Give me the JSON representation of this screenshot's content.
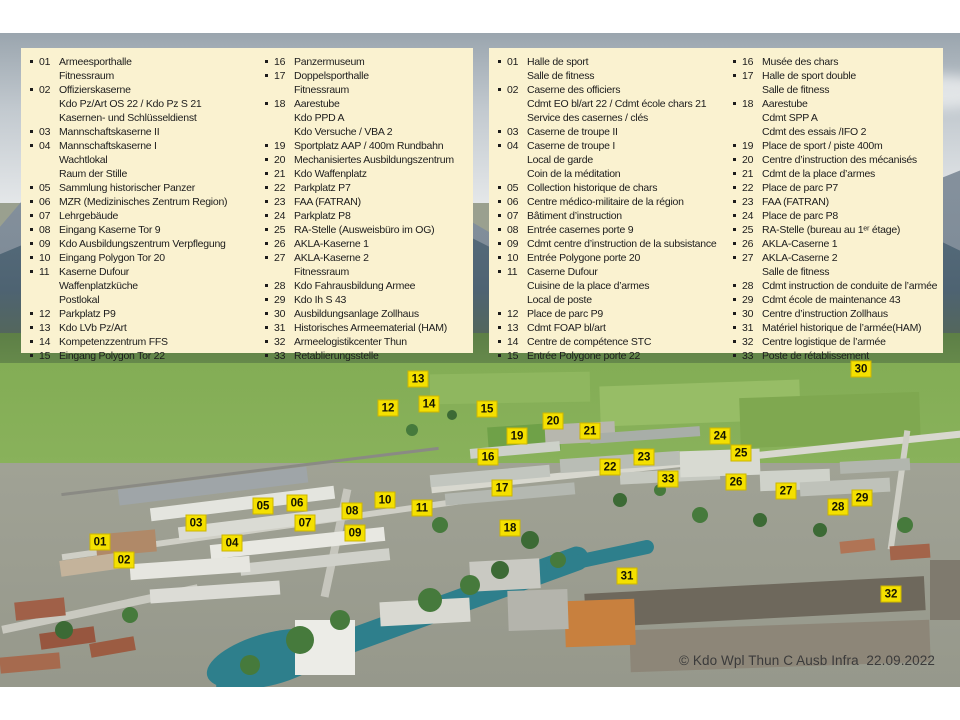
{
  "colors": {
    "legend_bg": "#FAF2D0",
    "marker_bg": "#F4E000",
    "marker_border": "#CDB600"
  },
  "copyright": "© Kdo Wpl Thun C Ausb Infra  22.09.2022",
  "legend_german": {
    "columns": [
      [
        {
          "num": "01",
          "lines": [
            "Armeesporthalle",
            "Fitnessraum"
          ]
        },
        {
          "num": "02",
          "lines": [
            "Offizierskaserne",
            "Kdo Pz/Art OS 22 / Kdo Pz S 21",
            "Kasernen- und Schlüsseldienst"
          ]
        },
        {
          "num": "03",
          "lines": [
            "Mannschaftskaserne II"
          ]
        },
        {
          "num": "04",
          "lines": [
            "Mannschaftskaserne I",
            "Wachtlokal",
            "Raum der Stille"
          ]
        },
        {
          "num": "05",
          "lines": [
            "Sammlung historischer Panzer"
          ]
        },
        {
          "num": "06",
          "lines": [
            "MZR (Medizinisches Zentrum Region)"
          ]
        },
        {
          "num": "07",
          "lines": [
            "Lehrgebäude"
          ]
        },
        {
          "num": "08",
          "lines": [
            "Eingang Kaserne Tor 9"
          ]
        },
        {
          "num": "09",
          "lines": [
            "Kdo Ausbildungszentrum Verpflegung"
          ]
        },
        {
          "num": "10",
          "lines": [
            "Eingang Polygon Tor 20"
          ]
        },
        {
          "num": "11",
          "lines": [
            "Kaserne Dufour",
            "Waffenplatzküche",
            "Postlokal"
          ]
        },
        {
          "num": "12",
          "lines": [
            "Parkplatz P9"
          ]
        },
        {
          "num": "13",
          "lines": [
            "Kdo LVb Pz/Art"
          ]
        },
        {
          "num": "14",
          "lines": [
            "Kompetenzzentrum FFS"
          ]
        },
        {
          "num": "15",
          "lines": [
            "Eingang Polygon Tor 22"
          ]
        }
      ],
      [
        {
          "num": "16",
          "lines": [
            "Panzermuseum"
          ]
        },
        {
          "num": "17",
          "lines": [
            "Doppelsporthalle",
            "Fitnessraum"
          ]
        },
        {
          "num": "18",
          "lines": [
            "Aarestube",
            "Kdo PPD A",
            "Kdo Versuche / VBA 2"
          ]
        },
        {
          "num": "19",
          "lines": [
            "Sportplatz AAP / 400m Rundbahn"
          ]
        },
        {
          "num": "20",
          "lines": [
            "Mechanisiertes Ausbildungszentrum"
          ]
        },
        {
          "num": "21",
          "lines": [
            "Kdo Waffenplatz"
          ]
        },
        {
          "num": "22",
          "lines": [
            "Parkplatz P7"
          ]
        },
        {
          "num": "23",
          "lines": [
            "FAA (FATRAN)"
          ]
        },
        {
          "num": "24",
          "lines": [
            "Parkplatz P8"
          ]
        },
        {
          "num": "25",
          "lines": [
            "RA-Stelle (Ausweisbüro im OG)"
          ]
        },
        {
          "num": "26",
          "lines": [
            "AKLA-Kaserne 1"
          ]
        },
        {
          "num": "27",
          "lines": [
            "AKLA-Kaserne 2",
            "Fitnessraum"
          ]
        },
        {
          "num": "28",
          "lines": [
            "Kdo Fahrausbildung Armee"
          ]
        },
        {
          "num": "29",
          "lines": [
            "Kdo Ih S 43"
          ]
        },
        {
          "num": "30",
          "lines": [
            "Ausbildungsanlage Zollhaus"
          ]
        },
        {
          "num": "31",
          "lines": [
            "Historisches Armeematerial (HAM)"
          ]
        },
        {
          "num": "32",
          "lines": [
            "Armeelogistikcenter Thun"
          ]
        },
        {
          "num": "33",
          "lines": [
            "Retablierungsstelle"
          ]
        }
      ]
    ]
  },
  "legend_french": {
    "columns": [
      [
        {
          "num": "01",
          "lines": [
            "Halle de sport",
            "Salle de fitness"
          ]
        },
        {
          "num": "02",
          "lines": [
            "Caserne des officiers",
            "Cdmt EO bl/art 22 / Cdmt école chars 21",
            "Service des casernes / clés"
          ]
        },
        {
          "num": "03",
          "lines": [
            "Caserne de troupe II"
          ]
        },
        {
          "num": "04",
          "lines": [
            "Caserne de troupe I",
            "Local de garde",
            "Coin de la méditation"
          ]
        },
        {
          "num": "05",
          "lines": [
            "Collection historique de chars"
          ]
        },
        {
          "num": "06",
          "lines": [
            "Centre médico-militaire de la région"
          ]
        },
        {
          "num": "07",
          "lines": [
            "Bâtiment d’instruction"
          ]
        },
        {
          "num": "08",
          "lines": [
            "Entrée casernes porte 9"
          ]
        },
        {
          "num": "09",
          "lines": [
            "Cdmt centre d’instruction de la subsistance"
          ]
        },
        {
          "num": "10",
          "lines": [
            "Entrée Polygone porte 20"
          ]
        },
        {
          "num": "11",
          "lines": [
            "Caserne Dufour",
            "Cuisine de la place d’armes",
            "Local de poste"
          ]
        },
        {
          "num": "12",
          "lines": [
            "Place de parc P9"
          ]
        },
        {
          "num": "13",
          "lines": [
            "Cdmt FOAP bl/art"
          ]
        },
        {
          "num": "14",
          "lines": [
            "Centre de compétence STC"
          ]
        },
        {
          "num": "15",
          "lines": [
            "Entrée Polygone porte 22"
          ]
        }
      ],
      [
        {
          "num": "16",
          "lines": [
            "Musée des chars"
          ]
        },
        {
          "num": "17",
          "lines": [
            "Halle de sport double",
            "Salle de fitness"
          ]
        },
        {
          "num": "18",
          "lines": [
            "Aarestube",
            "Cdmt SPP A",
            "Cdmt des essais /IFO 2"
          ]
        },
        {
          "num": "19",
          "lines": [
            "Place de sport / piste 400m"
          ]
        },
        {
          "num": "20",
          "lines": [
            "Centre d’instruction des mécanisés"
          ]
        },
        {
          "num": "21",
          "lines": [
            "Cdmt de la place d’armes"
          ]
        },
        {
          "num": "22",
          "lines": [
            "Place de parc P7"
          ]
        },
        {
          "num": "23",
          "lines": [
            "FAA (FATRAN)"
          ]
        },
        {
          "num": "24",
          "lines": [
            "Place de parc P8"
          ]
        },
        {
          "num": "25",
          "lines": [
            "RA-Stelle (bureau au 1ᵉʳ étage)"
          ]
        },
        {
          "num": "26",
          "lines": [
            "AKLA-Caserne 1"
          ]
        },
        {
          "num": "27",
          "lines": [
            "AKLA-Caserne 2",
            "Salle de fitness"
          ]
        },
        {
          "num": "28",
          "lines": [
            "Cdmt instruction de conduite de l’armée"
          ]
        },
        {
          "num": "29",
          "lines": [
            "Cdmt école de maintenance 43"
          ]
        },
        {
          "num": "30",
          "lines": [
            "Centre d’instruction Zollhaus"
          ]
        },
        {
          "num": "31",
          "lines": [
            "Matériel historique de l’armée(HAM)"
          ]
        },
        {
          "num": "32",
          "lines": [
            "Centre logistique de l’armée"
          ]
        },
        {
          "num": "33",
          "lines": [
            "Poste de rétablissement"
          ]
        }
      ]
    ]
  },
  "map_markers": [
    {
      "num": "01",
      "x": 100,
      "y": 542
    },
    {
      "num": "02",
      "x": 124,
      "y": 560
    },
    {
      "num": "03",
      "x": 196,
      "y": 523
    },
    {
      "num": "04",
      "x": 232,
      "y": 543
    },
    {
      "num": "05",
      "x": 263,
      "y": 506
    },
    {
      "num": "06",
      "x": 297,
      "y": 503
    },
    {
      "num": "07",
      "x": 305,
      "y": 523
    },
    {
      "num": "08",
      "x": 352,
      "y": 511
    },
    {
      "num": "09",
      "x": 355,
      "y": 533
    },
    {
      "num": "10",
      "x": 385,
      "y": 500
    },
    {
      "num": "11",
      "x": 422,
      "y": 508
    },
    {
      "num": "12",
      "x": 388,
      "y": 408
    },
    {
      "num": "13",
      "x": 418,
      "y": 379
    },
    {
      "num": "14",
      "x": 429,
      "y": 404
    },
    {
      "num": "15",
      "x": 487,
      "y": 409
    },
    {
      "num": "16",
      "x": 488,
      "y": 457
    },
    {
      "num": "17",
      "x": 502,
      "y": 488
    },
    {
      "num": "18",
      "x": 510,
      "y": 528
    },
    {
      "num": "19",
      "x": 517,
      "y": 436
    },
    {
      "num": "20",
      "x": 553,
      "y": 421
    },
    {
      "num": "21",
      "x": 590,
      "y": 431
    },
    {
      "num": "22",
      "x": 610,
      "y": 467
    },
    {
      "num": "23",
      "x": 644,
      "y": 457
    },
    {
      "num": "24",
      "x": 720,
      "y": 436
    },
    {
      "num": "25",
      "x": 741,
      "y": 453
    },
    {
      "num": "26",
      "x": 736,
      "y": 482
    },
    {
      "num": "27",
      "x": 786,
      "y": 491
    },
    {
      "num": "28",
      "x": 838,
      "y": 507
    },
    {
      "num": "29",
      "x": 862,
      "y": 498
    },
    {
      "num": "30",
      "x": 861,
      "y": 369
    },
    {
      "num": "31",
      "x": 627,
      "y": 576
    },
    {
      "num": "32",
      "x": 891,
      "y": 594
    },
    {
      "num": "33",
      "x": 668,
      "y": 479
    }
  ]
}
